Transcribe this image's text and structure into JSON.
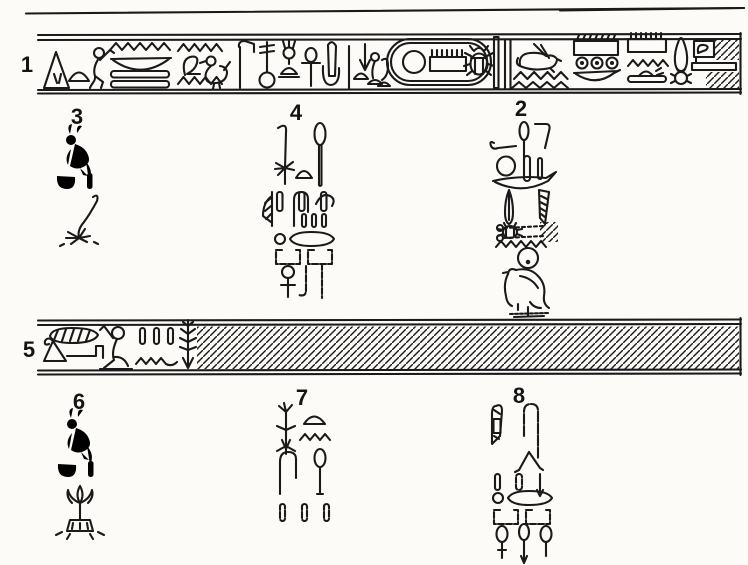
{
  "figure": {
    "type": "hieroglyphic-inscription-line-drawing",
    "ink_color": "#1a1a1a",
    "paper_color": "#fcfbf8",
    "labels": {
      "band1": "1",
      "col2": "2",
      "col3": "3",
      "col4": "4",
      "band5": "5",
      "col6": "6",
      "col7": "7",
      "col8": "8"
    },
    "bands": [
      {
        "id": "1",
        "label": "1",
        "glyphs": [
          "hatching",
          "tent-triangle",
          "bread-loaf",
          "seated-man",
          "water-ripples",
          "bowl",
          "double-mat-bars",
          "folded-cloth",
          "chick-bird",
          "adze-staff",
          "sekhem-staff-with-ring",
          "head-standard",
          "ankh",
          "dagger",
          "tall-stroke",
          "hatching",
          "down-arrow",
          "small-figures",
          "cartouche",
          "sun-disk",
          "comb-sign",
          "scarab",
          "double-stroke-divider",
          "hare",
          "water-ripples",
          "ticked-box",
          "three-rings",
          "bowl",
          "comb-box",
          "water-ripples",
          "loaf-on-bar",
          "pestle",
          "curl-box",
          "damaged-hatch",
          "bar"
        ]
      },
      {
        "id": "5",
        "label": "5",
        "glyphs": [
          "hatched-oval",
          "triangle-with-curl",
          "bracket-arm",
          "hatching",
          "kneeling-man-arm-raised",
          "three-strokes",
          "water-ripples",
          "tree-sign",
          "damaged-hatched-area"
        ]
      }
    ],
    "columns": [
      {
        "id": "3",
        "label": "3",
        "glyphs": [
          "crested-bird",
          "bowl",
          "stroke",
          "bent-plant-stem"
        ]
      },
      {
        "id": "4",
        "label": "4",
        "glyphs": [
          "reed-stem-with-roots",
          "mace",
          "bread-loaf",
          "three-strokes",
          "hatched-leaf",
          "hook-sign",
          "wing-curve",
          "three-small-strokes",
          "ring",
          "lens-oval",
          "two-open-boxes",
          "circle-cross-sign",
          "hook",
          "long-stroke"
        ]
      },
      {
        "id": "2",
        "label": "2",
        "glyphs": [
          "hatching",
          "arm-with-hand",
          "mace",
          "bent-club",
          "ring",
          "thick-stroke",
          "small-stroke",
          "boat",
          "feather",
          "scarab-beetle",
          "hatched-knife",
          "dotted-cords",
          "water-ripples",
          "sun-disk",
          "falcon",
          "base-strokes"
        ]
      },
      {
        "id": "6",
        "label": "6",
        "glyphs": [
          "crested-bird",
          "bowl",
          "stroke",
          "lotus-on-mound"
        ]
      },
      {
        "id": "7",
        "label": "7",
        "glyphs": [
          "rooted-plant",
          "bread-loaf",
          "water-ripples",
          "hook-sign",
          "mace",
          "three-strokes"
        ]
      },
      {
        "id": "8",
        "label": "8",
        "glyphs": [
          "hatched-knife",
          "long-crook",
          "open-triangle",
          "three-strokes",
          "ring",
          "lens-oval",
          "two-open-boxes",
          "three-jars",
          "hatching"
        ]
      }
    ]
  }
}
